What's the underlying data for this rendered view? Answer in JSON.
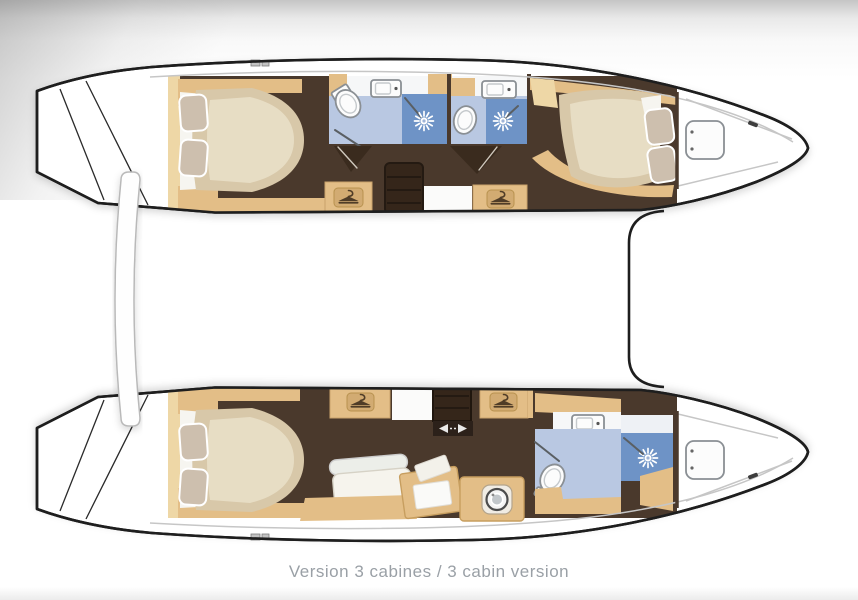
{
  "caption": {
    "text": "Version 3 cabines / 3 cabin version"
  },
  "palette": {
    "hull_outline": "#1e1e1e",
    "deck_line": "#c6c6c6",
    "floor": "#4a392c",
    "cabinet_dark": "#35261a",
    "joinery": "#e3be87",
    "joinery_light": "#eed7a6",
    "icon_plate": "#d2ab72",
    "icon_glyph": "#4f3c27",
    "mattress": "#d8c8a9",
    "mattress_hi": "#eae0c9",
    "pillow": "#cdbfae",
    "sheet": "#f6f5f0",
    "bath_floor": "#b9c8e2",
    "shower": "#6e93c6",
    "fixture_stroke": "#8a8f94",
    "caption_color": "#9aa0a6"
  },
  "icons": {
    "hanger-icon": "clothes-hanger pictogram on wardrobe lockers",
    "shower-head-icon": "white sunburst shower head",
    "washing-machine-icon": "porthole double circle",
    "deck-hatch-icon": "rounded-square deck hatch with hinge dots",
    "sliding-door-arrows-icon": "opposed white arrows",
    "stairs-icon": "companionway steps with treads"
  },
  "plan": {
    "type": "catamaran deck/accommodation plan, bows to the right",
    "top_hull_features": [
      "aft double-bed cabin",
      "two bathrooms with shower stalls",
      "forward double-bed cabin",
      "forepeak with deck hatch",
      "two wardrobe lockers",
      "companionway steps"
    ],
    "bottom_hull_features": [
      "aft double-bed cabin",
      "two wardrobe lockers",
      "chaise longue and desk",
      "washing machine cabinet",
      "forward bathroom with shower",
      "forepeak with deck hatch"
    ]
  }
}
